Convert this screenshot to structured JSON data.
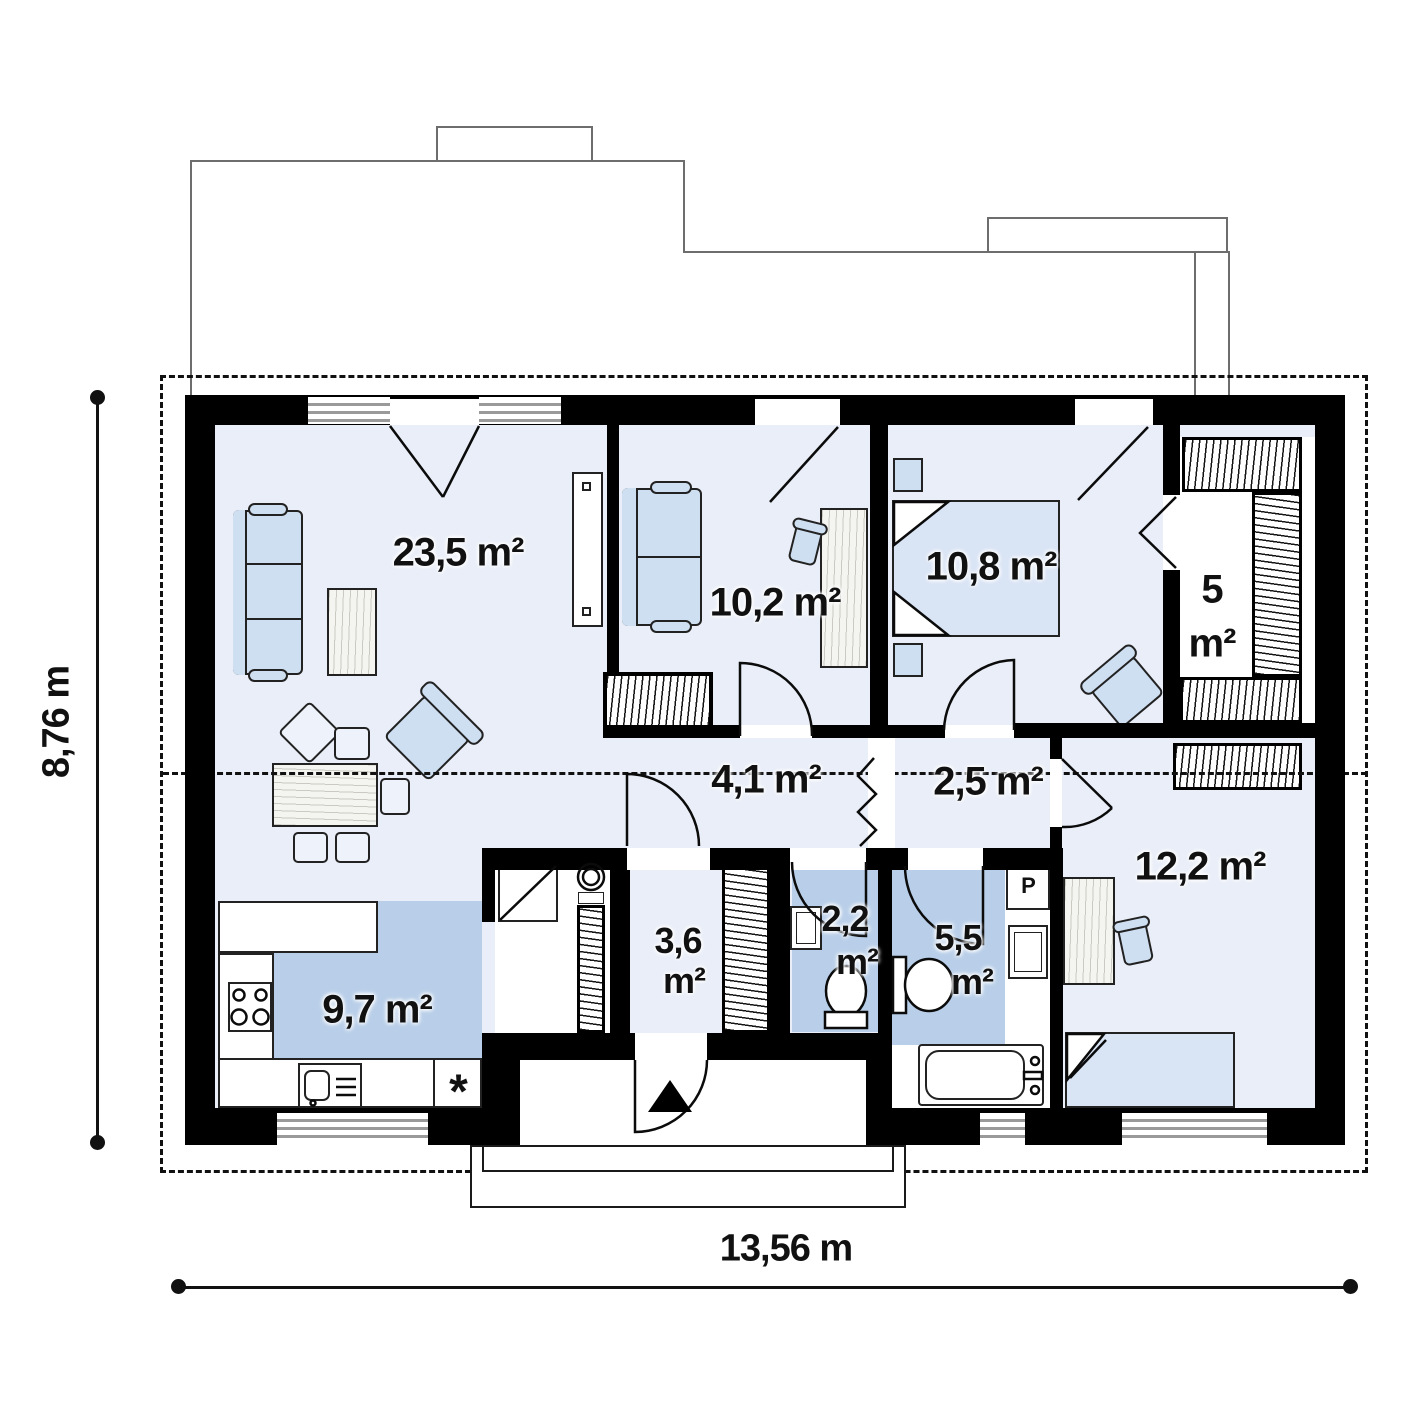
{
  "plan": {
    "type": "single-storey house floor plan",
    "dimensions": {
      "width": "13,56 m",
      "height": "8,76 m"
    },
    "rooms": {
      "living": {
        "area": "23,5 m²"
      },
      "lounge": {
        "area": "10,2 m²"
      },
      "bedroom": {
        "area": "10,8 m²"
      },
      "wardrobe": {
        "line1": "5",
        "line2": "m²"
      },
      "hall": {
        "area": "4,1 m²"
      },
      "corridor": {
        "area": "2,5 m²"
      },
      "cabinet": {
        "area": "12,2 m²"
      },
      "kitchen": {
        "area": "9,7 m²"
      },
      "entry": {
        "line1": "3,6",
        "line2": "m²"
      },
      "wc": {
        "line1": "2,2",
        "line2": "m²"
      },
      "bathroom": {
        "line1": "5,5",
        "line2": "m²"
      }
    },
    "symbols": {
      "dishwasher": "*",
      "washing_machine": "P"
    }
  },
  "colors": {
    "wall": "#000000",
    "floor": "#e9eef8",
    "zone": "#b9cfe9",
    "furn": "#cfdff2",
    "bed": "#d9e4f5",
    "wood": "#f4f4f1",
    "ink": "#111111",
    "stripe": "#9a9a9a",
    "white": "#ffffff"
  }
}
